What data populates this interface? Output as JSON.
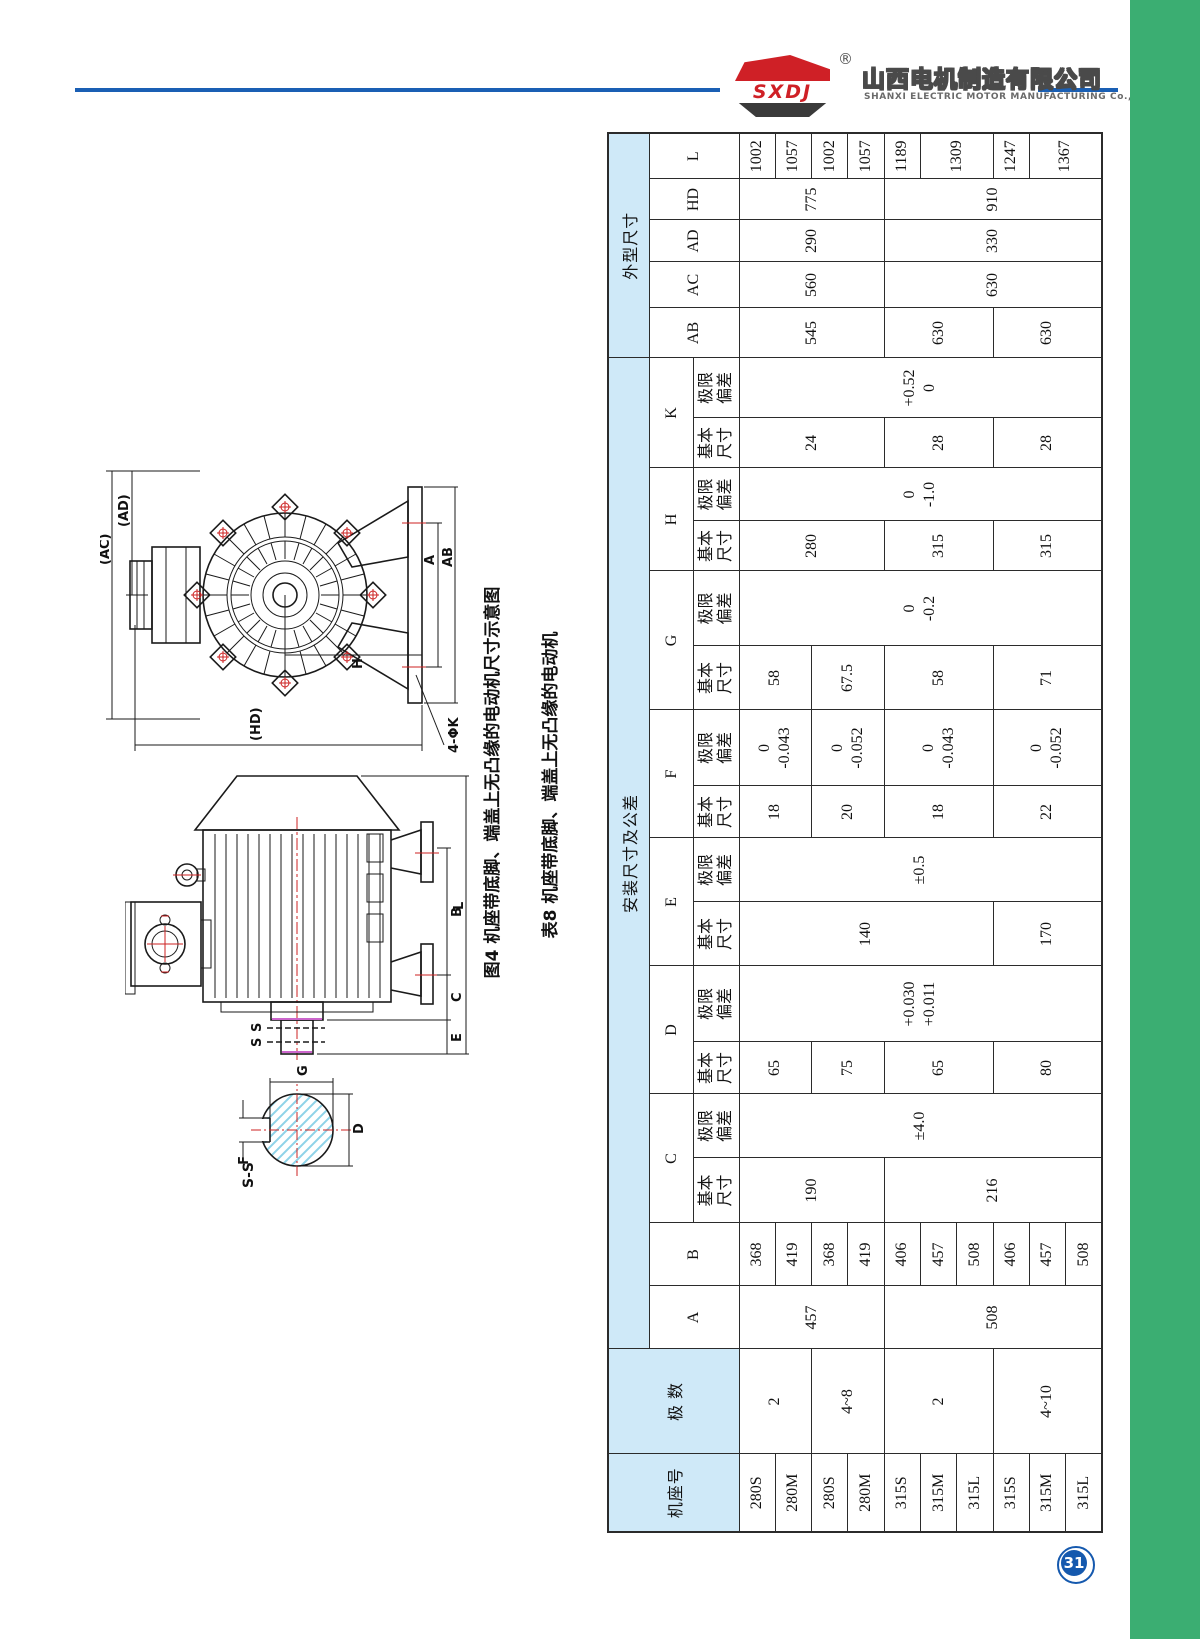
{
  "page": {
    "number": "31"
  },
  "header": {
    "logo_text": "SXDJ",
    "registered": "®",
    "company_cn": "山西电机制造有限公司",
    "company_en": "SHANXI ELECTRIC MOTOR MANUFACTURING Co.,Ltd.",
    "accent_blue": "#1a5fb4",
    "logo_red": "#cf2026",
    "sidebar_green": "#3bae72"
  },
  "figures": {
    "fig_caption": "图4 机座带底脚、端盖上无凸缘的电动机尺寸示意图",
    "table_caption": "表8 机座带底脚、端盖上无凸缘的电动机",
    "end_view": {
      "ac": "(AC)",
      "ad": "(AD)",
      "a": "A",
      "ab": "AB",
      "h": "H",
      "hd": "(HD)",
      "k_holes": "4-ΦK"
    },
    "side_view": {
      "b": "B",
      "c": "C",
      "e": "E",
      "l": "L",
      "s1": "S",
      "s2": "S"
    },
    "section_view": {
      "title": "S-S",
      "g": "G",
      "d": "D",
      "f": "F"
    }
  },
  "table": {
    "headers": {
      "frame": "机座号",
      "poles": "极 数",
      "install": "安装尺寸及公差",
      "outline": "外型尺寸",
      "basic": "基本\n尺寸",
      "limit": "极限\n偏差",
      "dims": [
        "A",
        "B",
        "C",
        "D",
        "E",
        "F",
        "G",
        "H",
        "K",
        "AB",
        "AC",
        "AD",
        "HD",
        "L"
      ]
    },
    "values": {
      "frames": [
        "280S",
        "280M",
        "280S",
        "280M",
        "315S",
        "315M",
        "315L",
        "315S",
        "315M",
        "315L"
      ],
      "poles": [
        "2",
        "4~8",
        "2",
        "4~10"
      ],
      "A": [
        "457",
        "508"
      ],
      "B": [
        "368",
        "419",
        "368",
        "419",
        "406",
        "457",
        "508",
        "406",
        "457",
        "508"
      ],
      "C_basic": [
        "190",
        "216"
      ],
      "C_limit": "±4.0",
      "D_basic": [
        "65",
        "75",
        "65",
        "80"
      ],
      "D_limit": "+0.030\n+0.011",
      "E_basic": [
        "140",
        "170"
      ],
      "E_limit": "±0.5",
      "F_basic": [
        "18",
        "20",
        "18",
        "22"
      ],
      "F_limit": [
        "0\n-0.043",
        "0\n-0.052",
        "0\n-0.043",
        "0\n-0.052"
      ],
      "G_basic": [
        "58",
        "67.5",
        "58",
        "71"
      ],
      "G_limit": "0\n-0.2",
      "H_basic": [
        "280",
        "315",
        "315"
      ],
      "H_limit": "0\n-1.0",
      "K_basic": [
        "24",
        "28",
        "28"
      ],
      "K_limit": "+0.52\n0",
      "AB": [
        "545",
        "630",
        "630"
      ],
      "AC": [
        "560",
        "630"
      ],
      "AD": [
        "290",
        "330"
      ],
      "HD": [
        "775",
        "910"
      ],
      "L": [
        "1002",
        "1057",
        "1002",
        "1057",
        "1189",
        "1309",
        "1247",
        "1367"
      ]
    }
  }
}
